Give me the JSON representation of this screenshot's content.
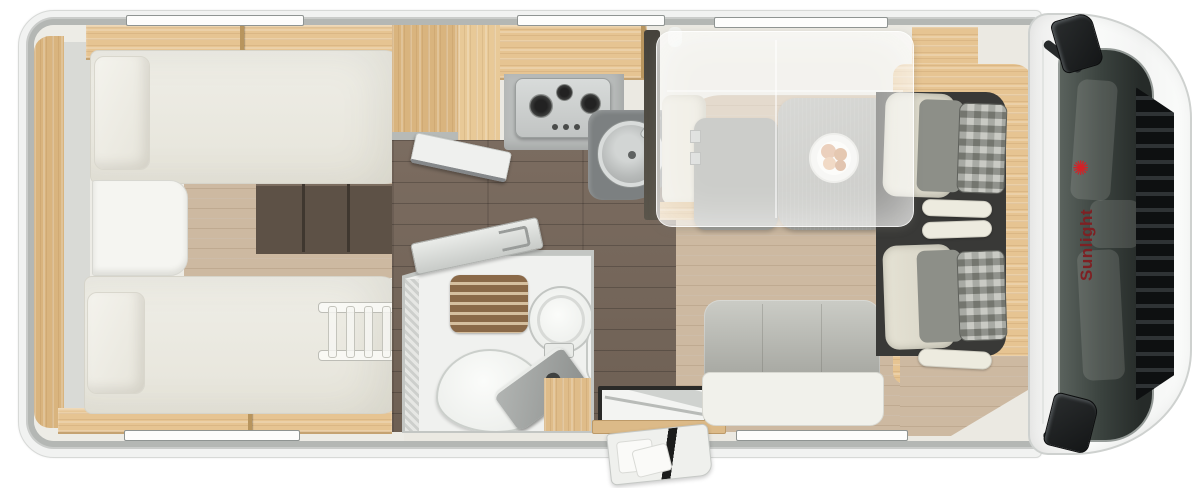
{
  "brand": {
    "name": "Sunlight"
  },
  "logo": {
    "icon": "✺"
  },
  "palette": {
    "wall": "#b4b7b4",
    "wood_light": "#e6c492",
    "wood_mid": "#d9b47e",
    "floor_light": "#cdb9a1",
    "floor_dark": "#74655a",
    "charcoal": "#393937",
    "counter": "#b9bcbb",
    "table_gray": "#a8a9a5",
    "mattress_ivory": "#ecebe3",
    "seat_cream": "#e1ded0",
    "seat_gray": "#8d8f88",
    "step_brown": "#5d5146",
    "shower_wood": "#8a6948",
    "windshield": "#3a423e",
    "logo_red": "#d42127",
    "logo_text": "#7e2023"
  }
}
